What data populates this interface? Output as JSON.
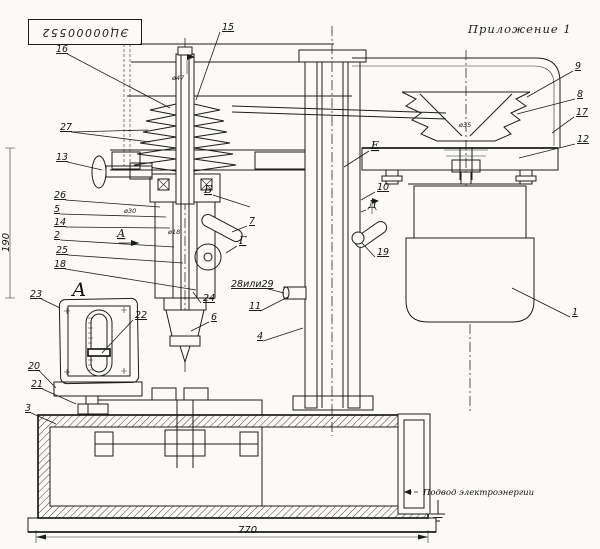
{
  "header": {
    "stamp": "ЭЦ00000552",
    "appendix": "Приложение 1"
  },
  "labels": {
    "power_supply": "Подвод электроэнергии"
  },
  "dimensions": {
    "base_width": "770",
    "left_height": "190"
  },
  "callouts": [
    {
      "n": "15",
      "x": 222,
      "y": 30,
      "tx": 196,
      "ty": 100
    },
    {
      "n": "16",
      "x": 56,
      "y": 52,
      "tx": 170,
      "ty": 108
    },
    {
      "n": "27",
      "x": 60,
      "y": 130,
      "tx": 148,
      "ty": 130,
      "tx2": 150,
      "ty2": 142
    },
    {
      "n": "13",
      "x": 56,
      "y": 160,
      "tx": 102,
      "ty": 170
    },
    {
      "n": "26",
      "x": 54,
      "y": 198,
      "tx": 160,
      "ty": 207
    },
    {
      "n": "5",
      "x": 54,
      "y": 212,
      "tx": 166,
      "ty": 217
    },
    {
      "n": "14",
      "x": 54,
      "y": 225,
      "tx": 170,
      "ty": 228
    },
    {
      "n": "2",
      "x": 54,
      "y": 238,
      "tx": 174,
      "ty": 247
    },
    {
      "n": "25",
      "x": 56,
      "y": 253,
      "tx": 183,
      "ty": 263
    },
    {
      "n": "18",
      "x": 54,
      "y": 267,
      "tx": 196,
      "ty": 290
    },
    {
      "n": "7",
      "x": 249,
      "y": 224,
      "tx": 232,
      "ty": 232
    },
    {
      "n": "24",
      "x": 203,
      "y": 301,
      "tx": 193,
      "ty": 292
    },
    {
      "n": "6",
      "x": 211,
      "y": 320,
      "tx": 191,
      "ty": 331
    },
    {
      "n": "28или29",
      "x": 231,
      "y": 287,
      "tx": 284,
      "ty": 293
    },
    {
      "n": "11",
      "x": 249,
      "y": 309,
      "tx": 288,
      "ty": 297
    },
    {
      "n": "4",
      "x": 257,
      "y": 339,
      "tx": 303,
      "ty": 328
    },
    {
      "n": "10",
      "x": 377,
      "y": 190,
      "tx": 361,
      "ty": 200
    },
    {
      "n": "19",
      "x": 377,
      "y": 255,
      "tx": 362,
      "ty": 243
    },
    {
      "n": "9",
      "x": 575,
      "y": 69,
      "tx": 527,
      "ty": 97
    },
    {
      "n": "8",
      "x": 577,
      "y": 97,
      "tx": 517,
      "ty": 114
    },
    {
      "n": "17",
      "x": 576,
      "y": 115,
      "tx": 552,
      "ty": 133
    },
    {
      "n": "12",
      "x": 577,
      "y": 142,
      "tx": 519,
      "ty": 158
    },
    {
      "n": "1",
      "x": 572,
      "y": 315,
      "tx": 512,
      "ty": 288
    },
    {
      "n": "3",
      "x": 25,
      "y": 411,
      "tx": 56,
      "ty": 424
    },
    {
      "n": "23",
      "x": 30,
      "y": 297,
      "tx": 60,
      "ty": 308
    },
    {
      "n": "22",
      "x": 135,
      "y": 318,
      "tx": 102,
      "ty": 353
    },
    {
      "n": "20",
      "x": 28,
      "y": 369,
      "tx": 56,
      "ty": 388
    },
    {
      "n": "21",
      "x": 31,
      "y": 387,
      "tx": 76,
      "ty": 404
    }
  ],
  "letters": [
    {
      "t": "А",
      "x": 72,
      "y": 296,
      "big": true
    },
    {
      "t": "А",
      "x": 117,
      "y": 237,
      "arrow": true
    },
    {
      "t": "Б",
      "x": 204,
      "y": 193,
      "tx": 250,
      "ty": 207
    },
    {
      "t": "Г",
      "x": 239,
      "y": 244,
      "tx": 226,
      "ty": 253
    },
    {
      "t": "Д",
      "x": 368,
      "y": 208,
      "tx": 361,
      "ty": 212
    },
    {
      "t": "Е",
      "x": 371,
      "y": 149,
      "tx": 344,
      "ty": 167
    }
  ],
  "small_dims": [
    {
      "t": "ø47",
      "x": 172,
      "y": 80
    },
    {
      "t": "ø30",
      "x": 124,
      "y": 213
    },
    {
      "t": "ø18",
      "x": 168,
      "y": 234
    },
    {
      "t": "ø35",
      "x": 459,
      "y": 127
    }
  ]
}
